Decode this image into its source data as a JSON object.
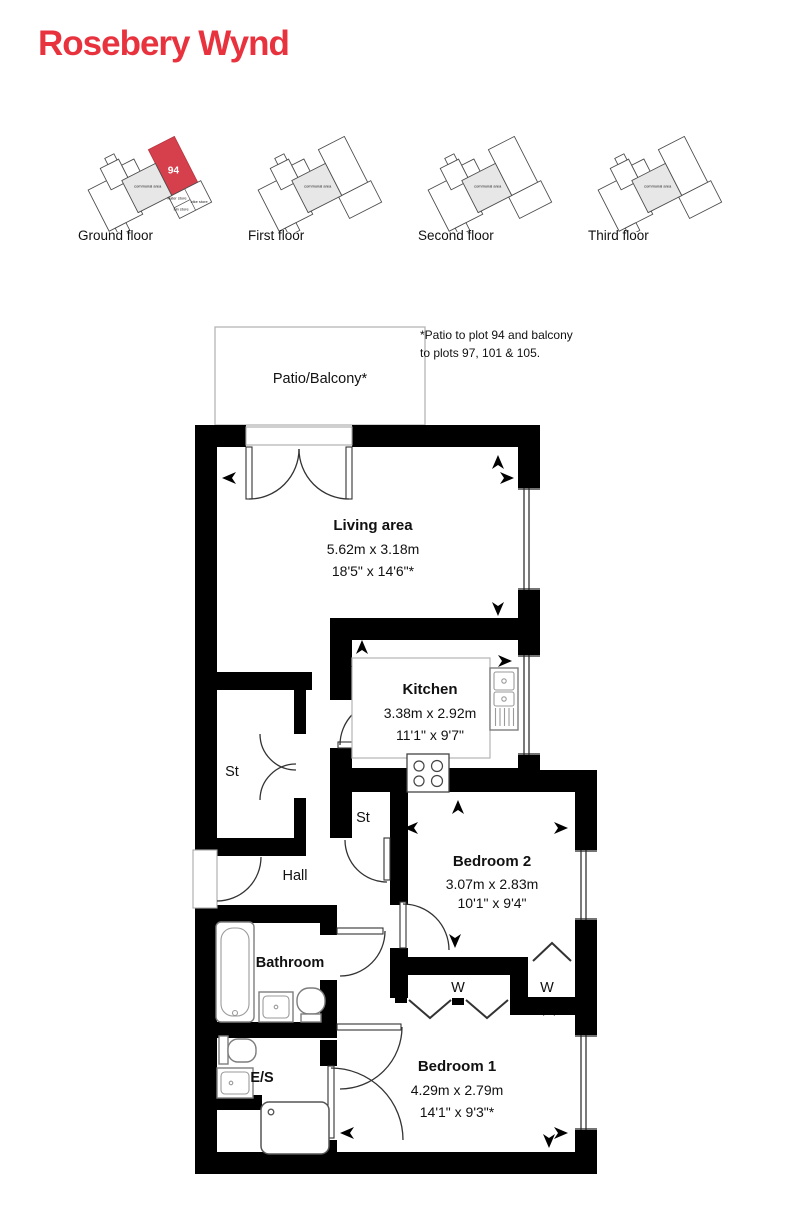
{
  "title": "Rosebery Wynd",
  "brand": {
    "title_red": "#e8333f",
    "plot_red": "#d5404c"
  },
  "floor_selector": {
    "floors": [
      {
        "label": "Ground floor",
        "plot_number": "94",
        "communal_label": "communal area",
        "store_labels": {
          "water": "water store",
          "bin": "bin store",
          "bike": "bike store"
        }
      },
      {
        "label": "First floor",
        "communal_label": "communal area"
      },
      {
        "label": "Second floor",
        "communal_label": "communal area"
      },
      {
        "label": "Third floor",
        "communal_label": "communal area"
      }
    ]
  },
  "note": {
    "line1": "*Patio to plot 94 and balcony",
    "line2": "to plots 97, 101 & 105."
  },
  "plan": {
    "patio_label": "Patio/Balcony*",
    "living": {
      "name": "Living area",
      "metric": "5.62m x 3.18m",
      "imperial": "18'5\" x 14'6\"*"
    },
    "kitchen": {
      "name": "Kitchen",
      "metric": "3.38m x 2.92m",
      "imperial": "11'1\" x 9'7\""
    },
    "bedroom2": {
      "name": "Bedroom 2",
      "metric": "3.07m x 2.83m",
      "imperial": "10'1\" x 9'4\""
    },
    "bedroom1": {
      "name": "Bedroom 1",
      "metric": "4.29m x 2.79m",
      "imperial": "14'1\" x 9'3\"*"
    },
    "bathroom_label": "Bathroom",
    "ensuite_label": "E/S",
    "hall_label": "Hall",
    "store_label": "St",
    "store2_label": "St",
    "wardrobe1_label": "W",
    "wardrobe2_label": "W"
  }
}
